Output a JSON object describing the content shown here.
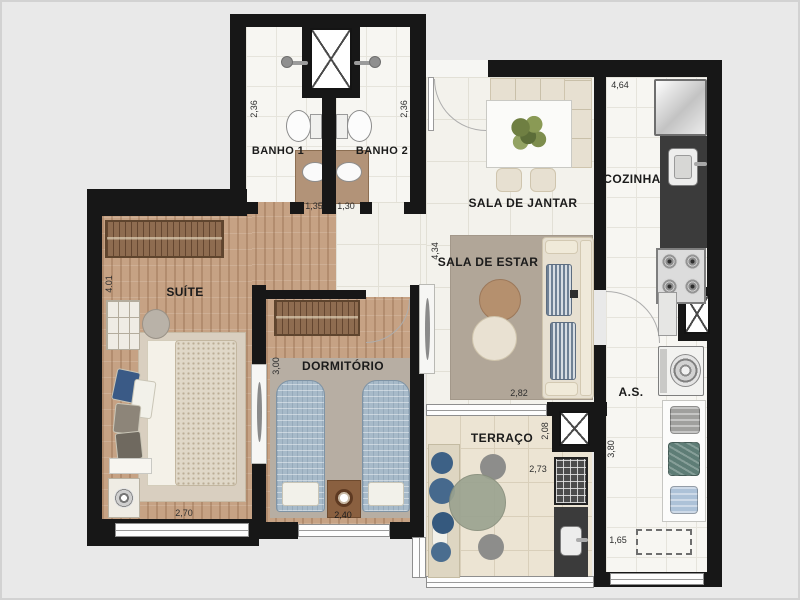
{
  "plan_type": "apartment-floor-plan",
  "colors": {
    "background": "#e9e9e9",
    "wall": "#171717",
    "wood": "#c6a284",
    "counter": "#3b3b3b",
    "bed_blue": "#a7bac9",
    "plant_blue": "#44688c",
    "rug_taupe": "#b1a698",
    "terrace_tile": "#ece4d3"
  },
  "rooms": {
    "banho1": {
      "label": "BANHO 1",
      "width_dim": "1,35",
      "height_dim": "2,36"
    },
    "banho2": {
      "label": "BANHO 2",
      "width_dim": "1,30",
      "height_dim": "2,36"
    },
    "sala_jantar": {
      "label": "SALA DE JANTAR"
    },
    "cozinha": {
      "label": "COZINHA",
      "width_dim": "4,64"
    },
    "sala_estar": {
      "label": "SALA DE ESTAR",
      "width_dim": "2,82",
      "height_dim": "4,34"
    },
    "suite": {
      "label": "SUÍTE",
      "width_dim": "2,70",
      "height_dim": "4.01"
    },
    "dormitorio": {
      "label": "DORMITÓRIO",
      "width_dim": "2,40",
      "height_dim": "3,00"
    },
    "terraco": {
      "label": "TERRAÇO",
      "width_dim": "2,73",
      "height_dim": "2,08"
    },
    "servico": {
      "label": "A.S.",
      "width_dim": "1,65",
      "height_dim": "3,80"
    }
  }
}
